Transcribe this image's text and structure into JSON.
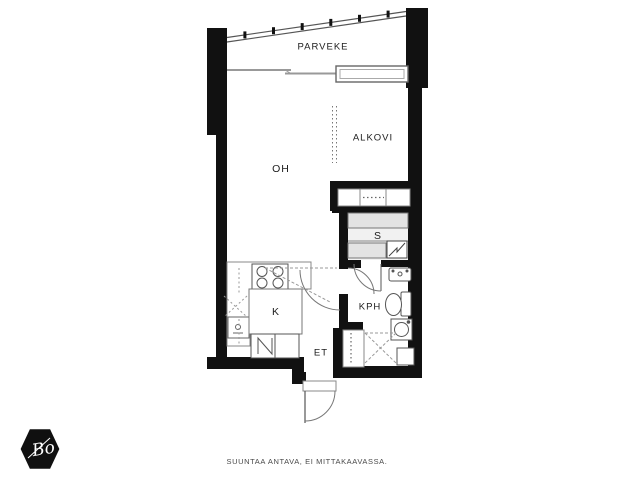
{
  "floorplan": {
    "rooms": [
      {
        "id": "parveke",
        "label": "PARVEKE"
      },
      {
        "id": "oh",
        "label": "OH"
      },
      {
        "id": "alkovi",
        "label": "ALKOVI"
      },
      {
        "id": "sauna",
        "label": "S"
      },
      {
        "id": "keittio",
        "label": "K"
      },
      {
        "id": "kph",
        "label": "KPH"
      },
      {
        "id": "et",
        "label": "ET"
      }
    ],
    "fixtures": [
      {
        "name": "balcony-glazing"
      },
      {
        "name": "sliding-window"
      },
      {
        "name": "window"
      },
      {
        "name": "wardrobe-row"
      },
      {
        "name": "sauna-benches"
      },
      {
        "name": "sauna-heater"
      },
      {
        "name": "stove"
      },
      {
        "name": "kitchen-sink"
      },
      {
        "name": "kitchen-island"
      },
      {
        "name": "fridge-freezer"
      },
      {
        "name": "bathroom-sink"
      },
      {
        "name": "toilet"
      },
      {
        "name": "washing-machine"
      },
      {
        "name": "entry-closet"
      },
      {
        "name": "entrance-door"
      },
      {
        "name": "interior-door-swings"
      }
    ],
    "disclaimer": "SUUNTAA ANTAVA, EI MITTAKAAVASSA.",
    "logo": {
      "text": "Bo"
    },
    "colors": {
      "wall": "#111111",
      "line": "#888888",
      "bench": "#e3e3e3",
      "sauna_floor": "#f1f1f1",
      "background": "#ffffff",
      "label": "#1c1c1c"
    }
  }
}
